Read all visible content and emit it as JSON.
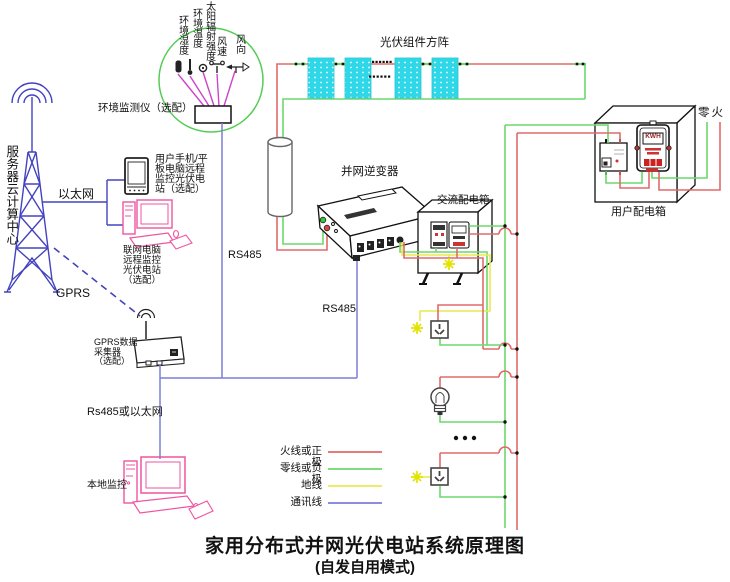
{
  "title": {
    "line1": "家用分布式并网光伏电站系统原理图",
    "line2": "(自发自用模式)"
  },
  "monitoring": {
    "station_label": "环境监测仪（选配）",
    "sensor_labels": {
      "humidity": "环境湿度",
      "temperature": "环境温度",
      "radiation": "太阳辐射强度",
      "wind_speed": "风速",
      "wind_direction": "风向"
    }
  },
  "remote": {
    "server": "服务器云计算中心",
    "ethernet": "以太网",
    "gprs": "GPRS",
    "tablet": "用户手机/平\n板电脑远程\n监控光伏电\n站（选配）",
    "pc": "联网电脑\n远程监控\n光伏电站\n（选配）",
    "collector": "GPRS数据\n采集器\n（选配）",
    "rs485_or_ethernet": "Rs485或以太网",
    "local_monitor": "本地监控"
  },
  "system": {
    "pv_array": "光伏组件方阵",
    "inverter": "并网逆变器",
    "rs485_monitor": "RS485",
    "rs485_inverter": "RS485",
    "ac_box": "交流配电箱",
    "user_box": "用户配电箱",
    "neutral_live": "零火",
    "meter_display": "KWH"
  },
  "legend": {
    "items": [
      {
        "label": "火线或正极",
        "color": "#e06a6a"
      },
      {
        "label": "零线或负极",
        "color": "#6cd96c"
      },
      {
        "label": "地线",
        "color": "#e9e955"
      },
      {
        "label": "通讯线",
        "color": "#7d7dd8"
      }
    ]
  },
  "colors": {
    "wire_live": "#e06a6a",
    "wire_neutral": "#6cd96c",
    "wire_ground": "#e9e955",
    "wire_comm": "#7d7dd8",
    "network_blue": "#4343c0",
    "sensor_magenta": "#cc44cc",
    "pv_cyan": "#2fd8e8",
    "device_pink": "#ee55a0",
    "circle_green": "#55cc55"
  }
}
